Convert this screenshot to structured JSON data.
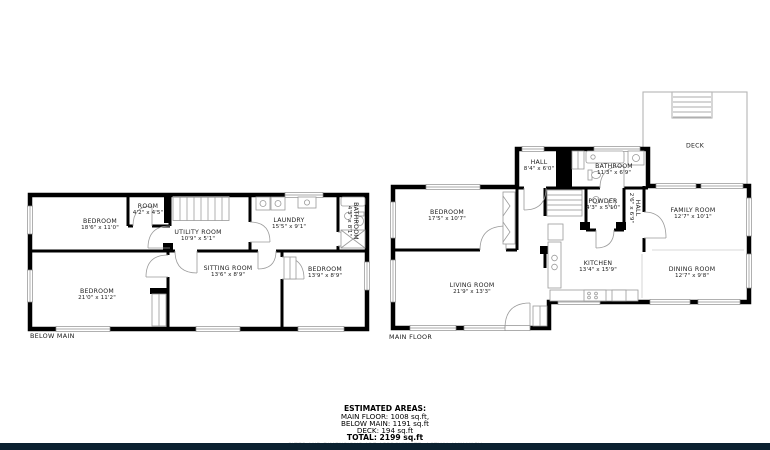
{
  "plans": {
    "below_main": {
      "label": "BELOW MAIN",
      "rooms": {
        "bedroom_1": {
          "name": "BEDROOM",
          "dims": "18'6\" x 11'0\""
        },
        "room": {
          "name": "ROOM",
          "dims": "4'2\" x 4'5\""
        },
        "utility": {
          "name": "UTILITY ROOM",
          "dims": "10'9\" x 5'1\""
        },
        "laundry": {
          "name": "LAUNDRY",
          "dims": "15'5\" x 9'1\""
        },
        "bathroom": {
          "name": "BATHROOM",
          "dims": "4'5\" x 8'1\""
        },
        "bedroom_2": {
          "name": "BEDROOM",
          "dims": "21'0\" x 11'2\""
        },
        "sitting": {
          "name": "SITTING ROOM",
          "dims": "13'6\" x 8'9\""
        },
        "bedroom_3": {
          "name": "BEDROOM",
          "dims": "13'9\" x 8'9\""
        }
      }
    },
    "main_floor": {
      "label": "MAIN FLOOR",
      "rooms": {
        "hall": {
          "name": "HALL",
          "dims": "8'4\" x 6'0\""
        },
        "bathroom": {
          "name": "BATHROOM",
          "dims": "11'3\" x 6'9\""
        },
        "bedroom": {
          "name": "BEDROOM",
          "dims": "17'5\" x 10'7\""
        },
        "powder": {
          "name": "POWDER",
          "dims": "4'3\" x 5'10\""
        },
        "hall_2": {
          "name": "HALL",
          "dims": "2'6\" x 6'9\""
        },
        "family": {
          "name": "FAMILY ROOM",
          "dims": "12'7\" x 10'1\""
        },
        "kitchen": {
          "name": "KITCHEN",
          "dims": "13'4\" x 15'9\""
        },
        "dining": {
          "name": "DINING ROOM",
          "dims": "12'7\" x 9'8\""
        },
        "living": {
          "name": "LIVING ROOM",
          "dims": "21'9\" x 13'3\""
        },
        "deck": {
          "name": "DECK",
          "dims": ""
        }
      }
    }
  },
  "summary": {
    "title": "ESTIMATED AREAS:",
    "main_floor": "MAIN FLOOR: 1008 sq.ft,",
    "below_main": "BELOW MAIN: 1191 sq.ft",
    "deck": "DECK: 194 sq.ft",
    "total": "TOTAL: 2199 sq.ft",
    "disclaimer": "SIZES AND DIMENSIONS ARE APPROXIMATE, ACTUAL MAY VARY"
  },
  "colors": {
    "wall": "#000000",
    "fixture_line": "#9a9a9a",
    "deck_line": "#b5b5b5",
    "footer_bar": "#0b2130",
    "disclaimer_text": "#cfcfcf"
  }
}
